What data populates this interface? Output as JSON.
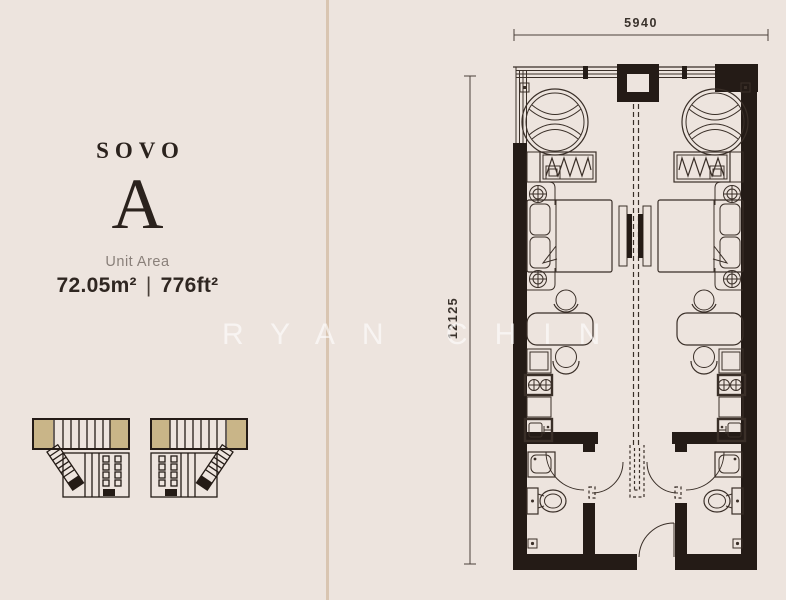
{
  "watermark": "RYAN CHIN",
  "unit_info": {
    "series_label": "SOVO",
    "unit_type": "A",
    "area_label": "Unit Area",
    "area_m2": "72.05m²",
    "area_separator": "|",
    "area_ft2": "776ft²"
  },
  "floor_plan": {
    "width_dimension": "5940",
    "depth_dimension": "12125"
  },
  "colors": {
    "background": "#EDE4DE",
    "divider": "#D9C5B1",
    "plan_line": "#3A2F28",
    "wall": "#241B16",
    "keyplan_highlight": "#C9B588",
    "text_dark": "#2B221D",
    "text_muted": "#8A807A",
    "watermark": "rgba(255,255,255,0.6)"
  }
}
